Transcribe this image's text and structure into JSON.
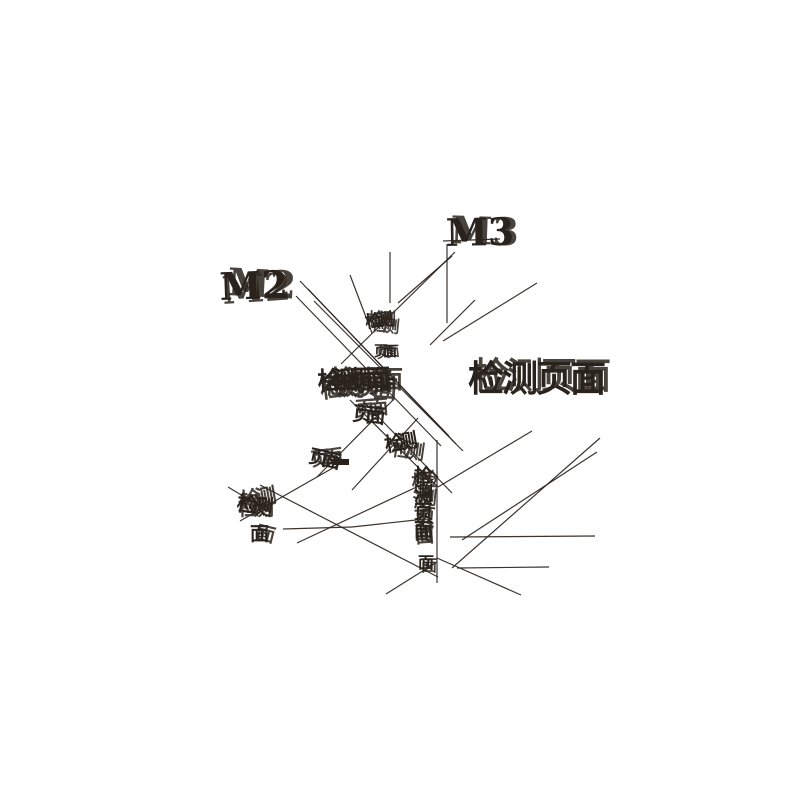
{
  "canvas": {
    "width": 800,
    "height": 800,
    "background": "#ffffff",
    "ink_color": "#2a231d",
    "line_opacity": 0.92
  },
  "figure": {
    "type": "glitched-node-graph",
    "labels": [
      {
        "name": "node-label-m3",
        "text": "M3",
        "x": 446,
        "y": 246,
        "size": 38,
        "spacing": 0,
        "ghosts": [
          [
            0,
            0,
            -1
          ],
          [
            4,
            -3,
            2
          ]
        ]
      },
      {
        "name": "node-label-m2",
        "text": "M2",
        "x": 220,
        "y": 300,
        "size": 38,
        "spacing": 0,
        "ghosts": [
          [
            0,
            0,
            -2
          ],
          [
            7,
            -5,
            3
          ],
          [
            3,
            4,
            -4
          ]
        ]
      },
      {
        "name": "node-label-page",
        "text": "检测页面",
        "x": 468,
        "y": 391,
        "size": 36,
        "spacing": -2,
        "ghosts": [
          [
            0,
            0,
            0
          ],
          [
            5,
            -3,
            0
          ]
        ]
      },
      {
        "name": "cluster-top",
        "text": "检测",
        "x": 366,
        "y": 328,
        "size": 17,
        "spacing": -6,
        "ghosts": [
          [
            0,
            0,
            -8
          ],
          [
            5,
            2,
            6
          ],
          [
            2,
            -3,
            0
          ]
        ]
      },
      {
        "name": "cluster-top-2",
        "text": "页面",
        "x": 374,
        "y": 356,
        "size": 14,
        "spacing": -5,
        "ghosts": [
          [
            0,
            0,
            0
          ],
          [
            3,
            2,
            -6
          ]
        ]
      },
      {
        "name": "cluster-center",
        "text": "检测页面",
        "x": 318,
        "y": 390,
        "size": 25,
        "spacing": -9,
        "ghosts": [
          [
            0,
            0,
            -3
          ],
          [
            6,
            3,
            4
          ],
          [
            12,
            -2,
            0
          ],
          [
            3,
            8,
            -7
          ]
        ]
      },
      {
        "name": "cluster-center-2",
        "text": "页面",
        "x": 352,
        "y": 420,
        "size": 20,
        "spacing": -7,
        "ghosts": [
          [
            0,
            0,
            6
          ],
          [
            4,
            -4,
            -5
          ]
        ]
      },
      {
        "name": "cluster-center-3",
        "text": "检测",
        "x": 386,
        "y": 452,
        "size": 20,
        "spacing": -7,
        "ghosts": [
          [
            0,
            0,
            -10
          ],
          [
            5,
            3,
            8
          ]
        ]
      },
      {
        "name": "cluster-left-mid",
        "text": "页面",
        "x": 308,
        "y": 462,
        "size": 19,
        "spacing": -6,
        "ghosts": [
          [
            0,
            0,
            12
          ],
          [
            4,
            4,
            -8
          ]
        ]
      },
      {
        "name": "cluster-bottom-left",
        "text": "检测",
        "x": 236,
        "y": 510,
        "size": 21,
        "spacing": -6,
        "ghosts": [
          [
            0,
            0,
            8
          ],
          [
            6,
            -2,
            -10
          ],
          [
            2,
            5,
            0
          ]
        ]
      },
      {
        "name": "cluster-bottom-left-2",
        "text": "面",
        "x": 250,
        "y": 540,
        "size": 19,
        "spacing": 0,
        "ghosts": [
          [
            0,
            0,
            0
          ],
          [
            5,
            -2,
            14
          ]
        ]
      },
      {
        "name": "cluster-bottom-column",
        "text": "检测页面",
        "x": 414,
        "y": 482,
        "size": 19,
        "spacing": 0,
        "vertical": true,
        "ghosts": [
          [
            0,
            0,
            0
          ],
          [
            5,
            3,
            5
          ],
          [
            -2,
            7,
            -4
          ]
        ]
      },
      {
        "name": "cluster-bottom-tail",
        "text": "面",
        "x": 418,
        "y": 568,
        "size": 16,
        "spacing": 0,
        "ghosts": [
          [
            0,
            0,
            0
          ],
          [
            3,
            3,
            0
          ]
        ]
      }
    ],
    "edges": [
      [
        443,
        241,
        500,
        239
      ],
      [
        447,
        244,
        447,
        323
      ],
      [
        390,
        252,
        390,
        303
      ],
      [
        537,
        283,
        443,
        341
      ],
      [
        300,
        281,
        449,
        436
      ],
      [
        308,
        289,
        456,
        444
      ],
      [
        296,
        296,
        441,
        446
      ],
      [
        314,
        301,
        463,
        451
      ],
      [
        350,
        275,
        372,
        333
      ],
      [
        452,
        256,
        398,
        303
      ],
      [
        455,
        252,
        341,
        364
      ],
      [
        600,
        438,
        452,
        568
      ],
      [
        597,
        452,
        462,
        540
      ],
      [
        450,
        537,
        595,
        536
      ],
      [
        457,
        568,
        549,
        567
      ],
      [
        260,
        485,
        438,
        577
      ],
      [
        297,
        543,
        438,
        477
      ],
      [
        283,
        529,
        352,
        527
      ],
      [
        240,
        521,
        345,
        461
      ],
      [
        228,
        487,
        263,
        508
      ],
      [
        393,
        400,
        317,
        477
      ],
      [
        418,
        418,
        352,
        490
      ],
      [
        350,
        400,
        438,
        487
      ],
      [
        365,
        403,
        452,
        493
      ],
      [
        438,
        487,
        532,
        431
      ],
      [
        437,
        440,
        437,
        583
      ],
      [
        437,
        558,
        521,
        595
      ],
      [
        437,
        562,
        386,
        594
      ],
      [
        352,
        527,
        425,
        519
      ],
      [
        475,
        300,
        430,
        345
      ]
    ],
    "marks": [
      {
        "x": 334,
        "y": 459,
        "w": 15,
        "h": 6
      }
    ]
  }
}
